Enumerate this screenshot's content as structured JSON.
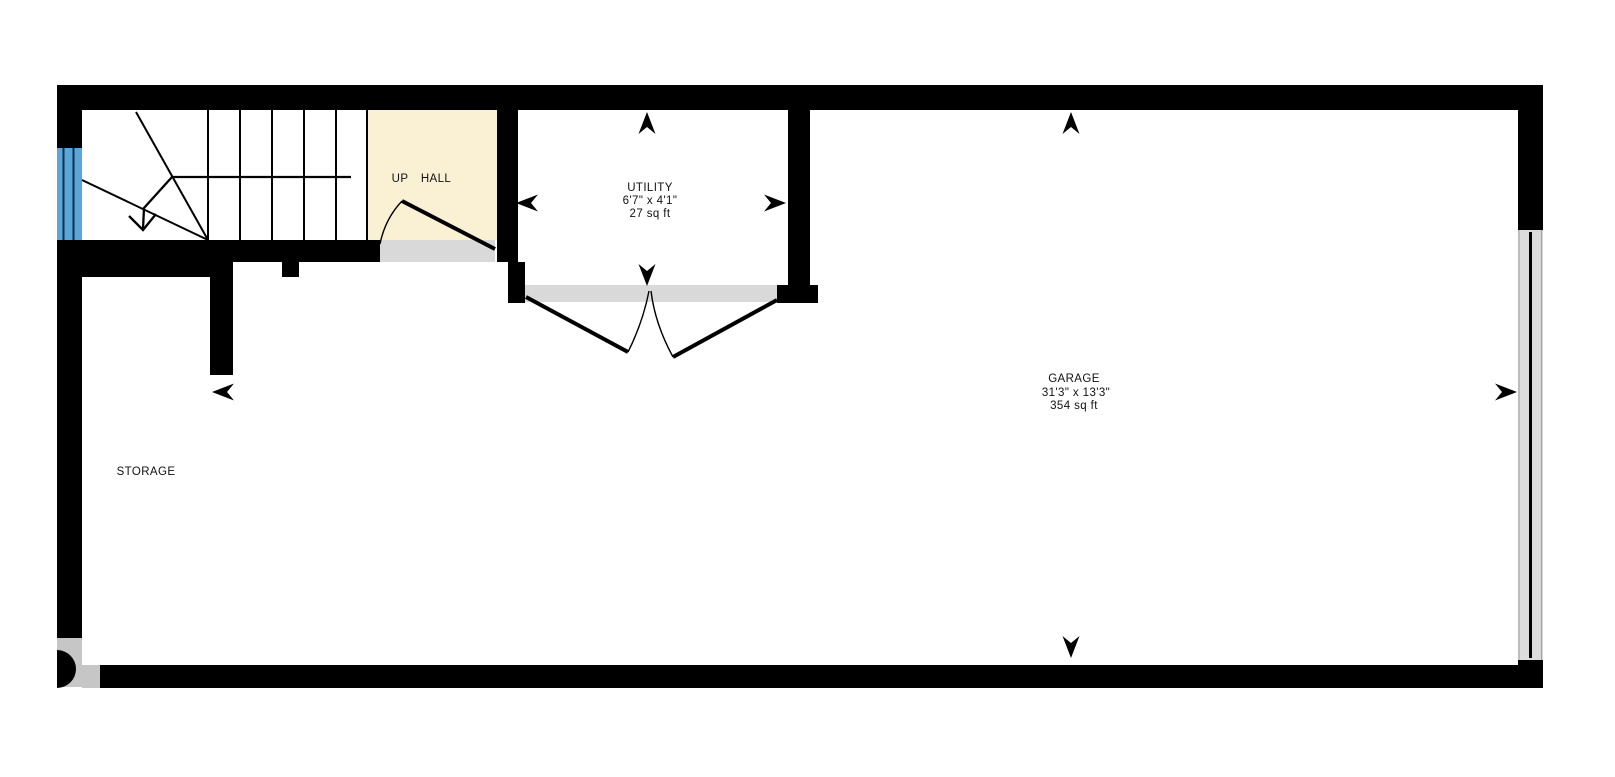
{
  "plan": {
    "rooms": {
      "hall": {
        "direction_label": "UP",
        "label": "HALL"
      },
      "utility": {
        "label": "UTILITY",
        "dimensions": "6'7\" x 4'1\"",
        "area": "27 sq ft"
      },
      "garage": {
        "label": "GARAGE",
        "dimensions": "31'3\" x 13'3\"",
        "area": "354 sq ft"
      },
      "storage": {
        "label": "STORAGE"
      }
    },
    "colors": {
      "wall": "#000000",
      "floor": "#ffffff",
      "hall_floor": "#faf1d5",
      "window_blue": "#5ba6d8",
      "threshold_gray": "#d9d9d9",
      "garage_door_gray": "#dcdcdc",
      "corner_door_gray": "#c6c6c6"
    },
    "icons": {
      "dimension_arrow": "concave-dart",
      "stair_direction_arrow": "open-v-arrowhead"
    }
  }
}
